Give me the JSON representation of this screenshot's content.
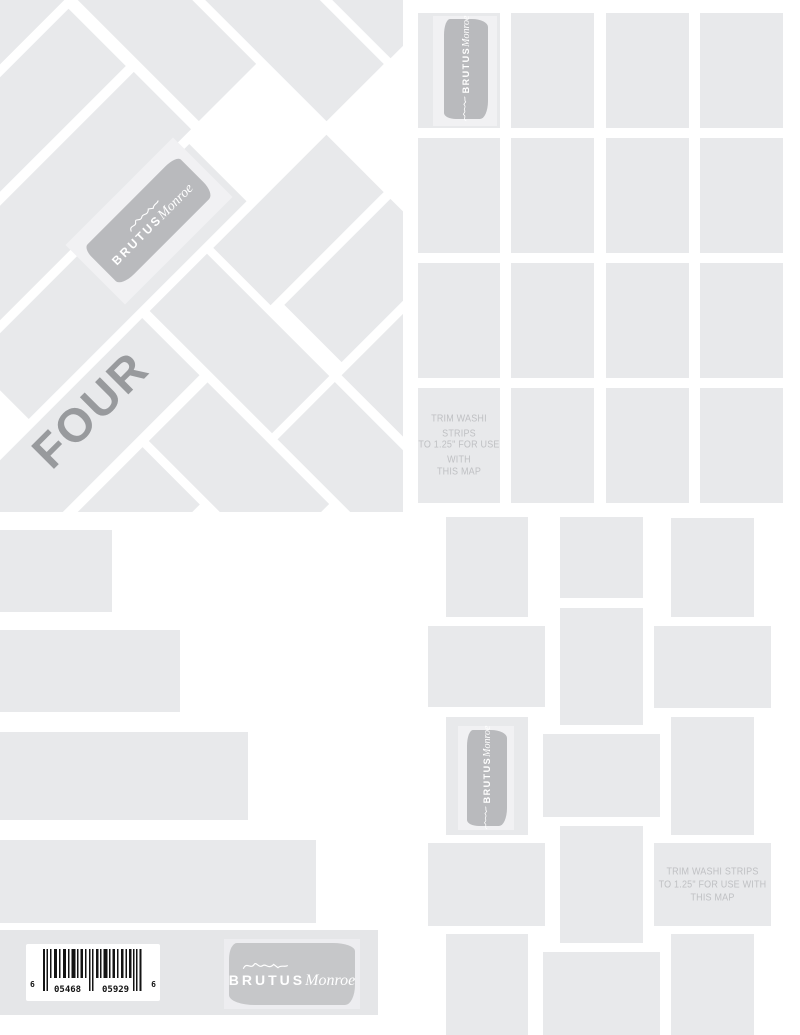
{
  "sheet": {
    "series_label": "FOUR"
  },
  "brand": {
    "caps": "BRUTUS",
    "script": "Monroe",
    "signature_icon": "handwritten-signature-scribble"
  },
  "washi_note": {
    "line1": "TRIM WASHI STRIPS",
    "line2": "TO 1.25\" FOR USE WITH",
    "line3": "THIS MAP"
  },
  "barcode": {
    "left_digit": "6",
    "group1": "05468",
    "group2": "05929",
    "right_digit": "6"
  },
  "colors": {
    "tile_gray": "#e8e9eb",
    "bottom_strip_gray": "#e5e6e8",
    "stamp_small_gray": "#b9babd",
    "stamp_large_gray": "#c6c7c9",
    "stamp_plate": "#f1f1f3",
    "series_text": "#989a9d",
    "note_text": "#bfc0c3",
    "barcode_bars": "#141414"
  }
}
